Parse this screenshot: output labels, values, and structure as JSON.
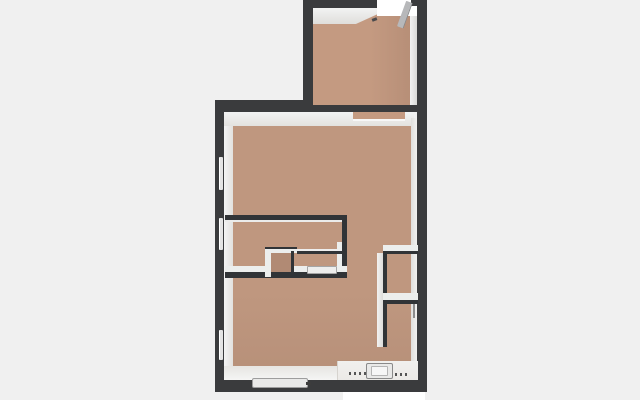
{
  "scene": {
    "type": "3d-floorplan-render",
    "visible_text": "",
    "rooms": [
      {
        "id": "upper-room"
      },
      {
        "id": "main-room"
      },
      {
        "id": "closet-box-1"
      },
      {
        "id": "closet-box-2"
      },
      {
        "id": "bathroom-area"
      }
    ],
    "window_count": 3,
    "door_count": 3
  },
  "colors": {
    "bg": "#f0f0f0",
    "wall": "#3a3b3d",
    "wallThin": "#313437",
    "face": "#eceeed",
    "faceBright": "#f2f3f3",
    "floor": "#bf977f",
    "floorUpper": "#c49a81",
    "floorDark": "#b18a74",
    "white": "#ffffff",
    "glass": "#e4e4e4",
    "doorLeaf": "#b7b8ba"
  }
}
